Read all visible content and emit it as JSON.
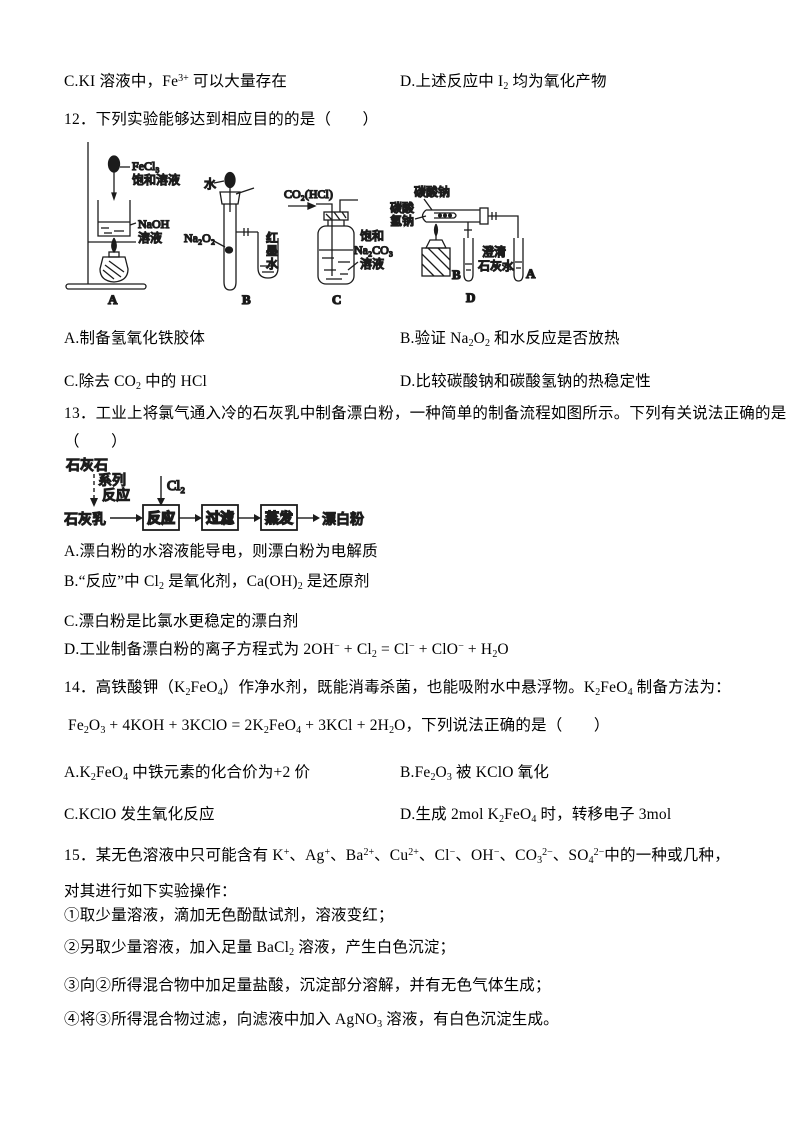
{
  "q11": {
    "option_c": "C.KI 溶液中，Fe^{3+} 可以大量存在",
    "option_d": "D.上述反应中 I_{2} 均为氧化产物"
  },
  "q12": {
    "stem": "12．下列实验能够达到相应目的的是（　　）",
    "figure": {
      "a": {
        "dropper1": "FeCl₃",
        "dropper2": "饱和溶液",
        "beaker1": "NaOH",
        "beaker2": "溶液",
        "tag": "A"
      },
      "b": {
        "water": "水",
        "solid": "Na₂O₂",
        "ink": [
          "红",
          "墨",
          "水"
        ],
        "tag": "B"
      },
      "c": {
        "gas": "CO₂(HCl)",
        "sol": [
          "饱和",
          "Na₂CO₃",
          "溶液"
        ],
        "tag": "C"
      },
      "d": {
        "top": "碳酸钠",
        "left": [
          "碳酸",
          "氢钠"
        ],
        "lime": [
          "澄清",
          "石灰水"
        ],
        "tube_b": "B",
        "tube_a": "A",
        "tag": "D"
      }
    },
    "options": {
      "a": "A.制备氢氧化铁胶体",
      "b": "B.验证 Na_{2}O_{2} 和水反应是否放热",
      "c": "C.除去 CO_{2} 中的 HCl",
      "d": "D.比较碳酸钠和碳酸氢钠的热稳定性"
    }
  },
  "q13": {
    "stem1": "13．工业上将氯气通入冷的石灰乳中制备漂白粉，一种简单的制备流程如图所示。下列有关说法正确的是",
    "stem2": "（　　）",
    "flow": {
      "limestone": "石灰石",
      "series": [
        "系列",
        "反应"
      ],
      "lime_milk": "石灰乳",
      "cl2": "Cl₂",
      "boxes": [
        "反应",
        "过滤",
        "蒸发"
      ],
      "product": "漂白粉"
    },
    "options": {
      "a": "A.漂白粉的水溶液能导电，则漂白粉为电解质",
      "b": "B.“反应”中 Cl_{2} 是氧化剂，Ca(OH)_{2} 是还原剂",
      "c": "C.漂白粉是比氯水更稳定的漂白剂",
      "d": "D.工业制备漂白粉的离子方程式为 2OH^{−} + Cl_{2} = Cl^{−} + ClO^{−} + H_{2}O"
    }
  },
  "q14": {
    "stem1": "14．高铁酸钾（K_{2}FeO_{4}）作净水剂，既能消毒杀菌，也能吸附水中悬浮物。K_{2}FeO_{4} 制备方法为：",
    "stem2": "Fe_{2}O_{3} + 4KOH + 3KClO = 2K_{2}FeO_{4} + 3KCl + 2H_{2}O，下列说法正确的是（　　）",
    "options": {
      "a": "A.K_{2}FeO_{4} 中铁元素的化合价为+2 价",
      "b": "B.Fe_{2}O_{3} 被 KClO 氧化",
      "c": "C.KClO 发生氧化反应",
      "d": "D.生成 2mol K_{2}FeO_{4} 时，转移电子 3mol"
    }
  },
  "q15": {
    "stem1": "15．某无色溶液中只可能含有 K^{+}、Ag^{+}、Ba^{2+}、Cu^{2+}、Cl^{−}、OH^{−}、CO_{3}^{2−}、SO_{4}^{2−}中的一种或几种，",
    "stem2": "对其进行如下实验操作：",
    "steps": [
      "①取少量溶液，滴加无色酚酞试剂，溶液变红；",
      "②另取少量溶液，加入足量 BaCl_{2} 溶液，产生白色沉淀；",
      "③向②所得混合物中加足量盐酸，沉淀部分溶解，并有无色气体生成；",
      "④将③所得混合物过滤，向滤液中加入 AgNO_{3} 溶液，有白色沉淀生成。"
    ]
  }
}
